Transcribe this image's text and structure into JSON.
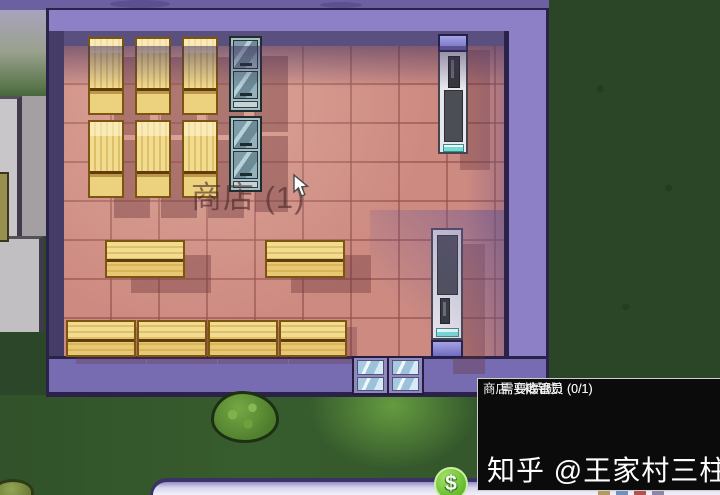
{
  "game": {
    "shop_label": "商店 (1)",
    "tooltip": {
      "title": "商店（未完成）",
      "requirements": [
        "需要收银员 (0/1)",
        "需要库管员 (0/1)"
      ]
    },
    "hud": {
      "coin_symbol": "$"
    }
  },
  "watermark": {
    "text": "知乎 @王家村三柱"
  },
  "colors": {
    "wall": "#8d80c6",
    "wall_shadow": "#595080",
    "floor": "#cd8a81",
    "grass_dark": "#2b4628",
    "grass_lawn": "#375c2d",
    "shelf_wood": "#f2dc90",
    "fridge_body": "#a9bec2",
    "coin_green": "#6cc133",
    "tooltip_bg": "#0b0b0b",
    "tooltip_text": "#f2f2f2"
  }
}
